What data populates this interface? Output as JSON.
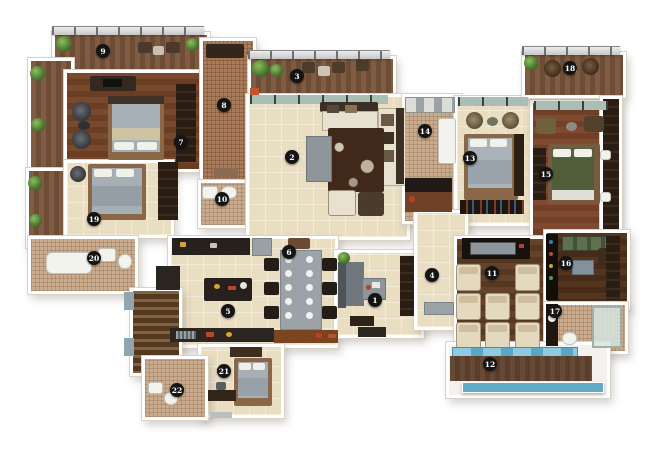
{
  "floorplan": {
    "markers": [
      {
        "label": "1",
        "name": "study",
        "x": 375,
        "y": 300
      },
      {
        "label": "2",
        "name": "living-room",
        "x": 292,
        "y": 157
      },
      {
        "label": "3",
        "name": "living-balcony",
        "x": 297,
        "y": 76
      },
      {
        "label": "4",
        "name": "foyer",
        "x": 432,
        "y": 275
      },
      {
        "label": "5",
        "name": "kitchen",
        "x": 228,
        "y": 311
      },
      {
        "label": "6",
        "name": "dining",
        "x": 289,
        "y": 252
      },
      {
        "label": "7",
        "name": "master-bedroom",
        "x": 181,
        "y": 142
      },
      {
        "label": "8",
        "name": "entrance-lobby",
        "x": 224,
        "y": 105
      },
      {
        "label": "9",
        "name": "master-balcony",
        "x": 103,
        "y": 51
      },
      {
        "label": "10",
        "name": "master-bathroom",
        "x": 222,
        "y": 199
      },
      {
        "label": "11",
        "name": "home-theater",
        "x": 492,
        "y": 273
      },
      {
        "label": "12",
        "name": "pool-deck",
        "x": 490,
        "y": 364
      },
      {
        "label": "13",
        "name": "bedroom-2",
        "x": 470,
        "y": 158
      },
      {
        "label": "14",
        "name": "utility-kitchen",
        "x": 425,
        "y": 131
      },
      {
        "label": "15",
        "name": "bedroom-3",
        "x": 546,
        "y": 174
      },
      {
        "label": "16",
        "name": "lounge-bar",
        "x": 566,
        "y": 263
      },
      {
        "label": "17",
        "name": "bathroom-3",
        "x": 555,
        "y": 311
      },
      {
        "label": "18",
        "name": "balcony-3",
        "x": 570,
        "y": 68
      },
      {
        "label": "19",
        "name": "bedroom-4",
        "x": 94,
        "y": 219
      },
      {
        "label": "20",
        "name": "bathroom-4",
        "x": 94,
        "y": 258
      },
      {
        "label": "21",
        "name": "bedroom-5",
        "x": 224,
        "y": 371
      },
      {
        "label": "22",
        "name": "bathroom-5",
        "x": 177,
        "y": 390
      }
    ],
    "palette": {
      "background": "#ffffff",
      "wall": "#ffffff",
      "floor_tile": "#e9dec2",
      "floor_wood": "#6f4427",
      "floor_deck": "#77543c",
      "floor_mosaic": "#c9ab8d",
      "marker_bg": "#141414",
      "marker_text": "#ffffff",
      "pool_water": "#6fb4cd",
      "plant_green": "#5c8a3c"
    }
  }
}
